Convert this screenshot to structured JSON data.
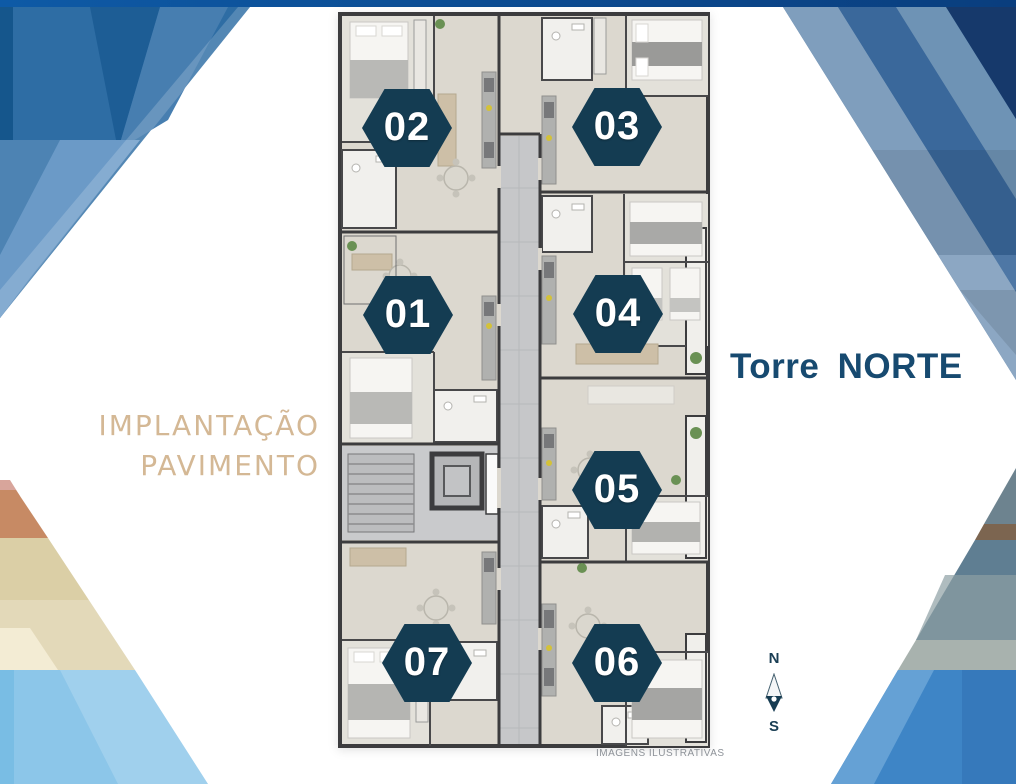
{
  "heading": {
    "line1": "IMPLANTAÇÃO",
    "line2": "PAVIMENTO",
    "color": "#d4b895"
  },
  "tower_label": {
    "text": "Torre NORTE",
    "color": "#174a70"
  },
  "floor_plan": {
    "badge_color": "#143c52",
    "disclaimer": "IMAGENS ILUSTRATIVAS",
    "units": [
      {
        "id": "unit-02",
        "number": "02"
      },
      {
        "id": "unit-03",
        "number": "03"
      },
      {
        "id": "unit-01",
        "number": "01"
      },
      {
        "id": "unit-04",
        "number": "04"
      },
      {
        "id": "unit-05",
        "number": "05"
      },
      {
        "id": "unit-07",
        "number": "07"
      },
      {
        "id": "unit-06",
        "number": "06"
      }
    ]
  },
  "compass": {
    "north_label": "N",
    "south_label": "S",
    "color": "#1a3e54"
  },
  "colors": {
    "decoration_dark_blue": "#16396b",
    "decoration_mid_blue": "#2e6da4",
    "decoration_light_blue": "#8cc6e9",
    "decoration_khaki": "#dbcfa6",
    "decoration_salmon": "#c78a64",
    "plan_floor": "#dcd8cf",
    "plan_wall": "#3c3c3e"
  }
}
